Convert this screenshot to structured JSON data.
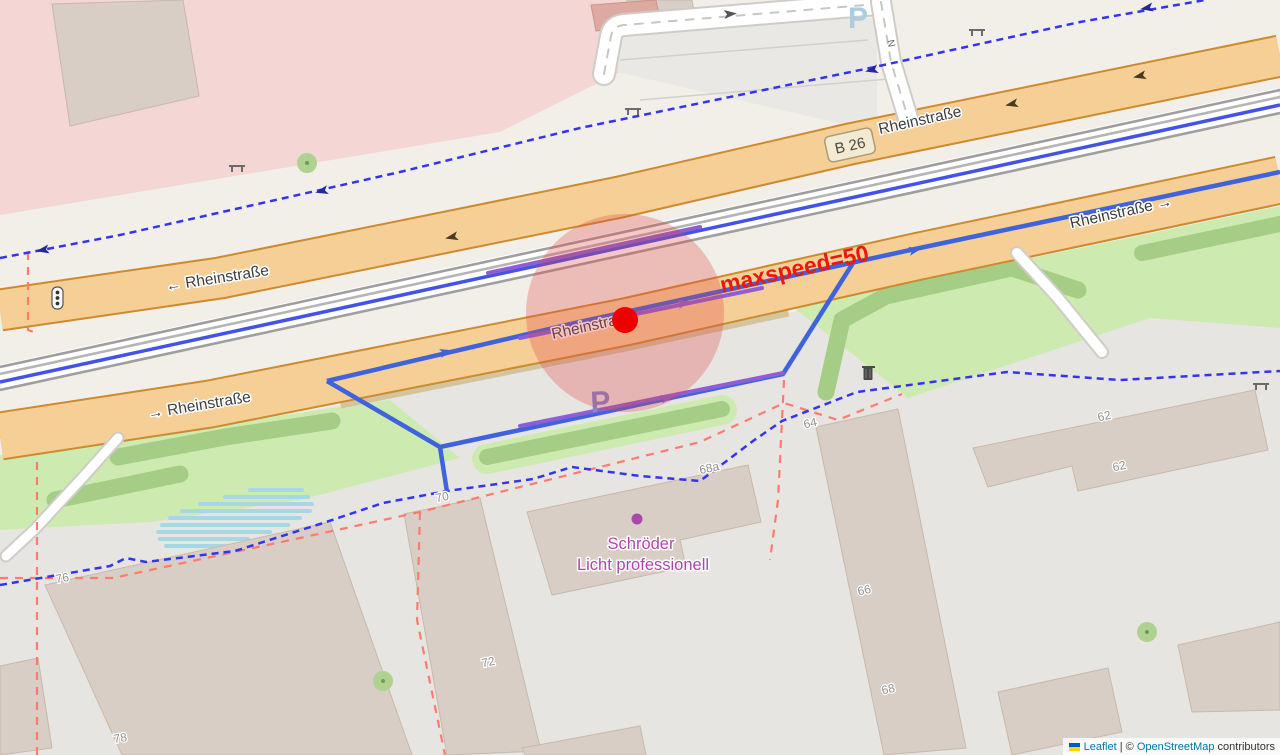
{
  "map": {
    "street_labels": [
      {
        "text": "← Rheinstraße"
      },
      {
        "text": "Rheinstraße"
      },
      {
        "text": "Rheinstraße"
      },
      {
        "text": "→ Rheinstraße"
      },
      {
        "text": "Rheinstraße →"
      }
    ],
    "route_ref": "B 26",
    "annotation": {
      "text": "maxspeed=50",
      "color": "#e8190f"
    },
    "poi": {
      "line1": "Schröder",
      "line2": "Licht professionell",
      "color": "#ab47ab"
    },
    "parking": {
      "label": "P",
      "label_pale": "P"
    },
    "road_marker": "N",
    "house_numbers": [
      "76",
      "78",
      "70",
      "72",
      "68a",
      "64",
      "62",
      "62",
      "66",
      "68"
    ],
    "marker": {
      "type": "selected-node",
      "color": "#ec0000",
      "halo_color": "#dd4444"
    },
    "route_color": "#3f62dd",
    "selected_way_color": "#8f5ed6"
  },
  "attribution": {
    "flag": "ukraine-flag",
    "leaflet": "Leaflet",
    "separator": " | © ",
    "osm": "OpenStreetMap",
    "suffix": " contributors"
  }
}
